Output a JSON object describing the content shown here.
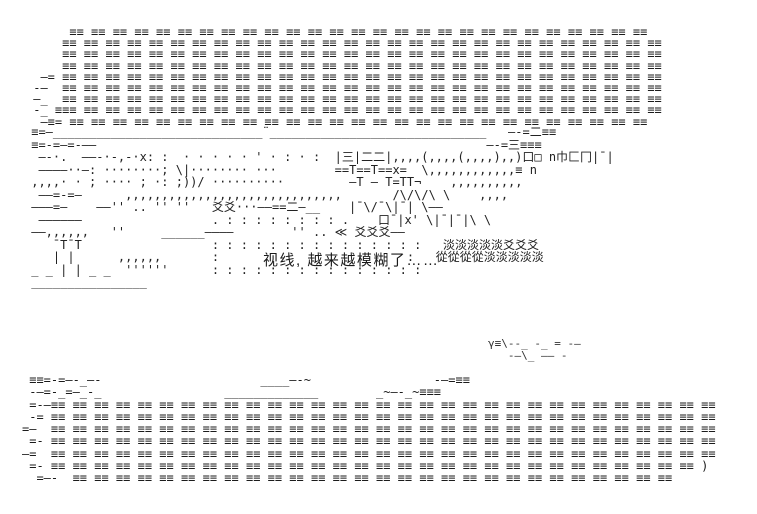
{
  "page": {
    "background_color": "#ffffff",
    "ink_color": "#1b1b1b",
    "description": "Monochrome ASCII-art (AA) scene: dense banner bands of triple-bar glyphs at top and bottom, a sketchy dotted landscape with rooftops and foliage glyphs in the middle, and one line of Chinese dialogue in a dotted speech box."
  },
  "dialog": {
    "text": "视线, 越来越模糊了……"
  },
  "aa": {
    "foliage_glyphs": "爻 淡 從",
    "top_banner": [
      "      ≡≡ ≡≡ ≡≡ ≡≡ ≡≡ ≡≡ ≡≡ ≡≡ ≡≡ ≡≡ ≡≡ ≡≡ ≡≡ ≡≡ ≡≡ ≡≡ ≡≡ ≡≡ ≡≡ ≡≡ ≡≡ ≡≡ ≡≡ ≡≡ ≡≡ ≡≡ ≡≡",
      "     ≡≡ ≡≡ ≡≡ ≡≡ ≡≡ ≡≡ ≡≡ ≡≡ ≡≡ ≡≡ ≡≡ ≡≡ ≡≡ ≡≡ ≡≡ ≡≡ ≡≡ ≡≡ ≡≡ ≡≡ ≡≡ ≡≡ ≡≡ ≡≡ ≡≡ ≡≡ ≡≡ ≡≡",
      "     ≡≡ ≡≡ ≡≡ ≡≡ ≡≡ ≡≡ ≡≡ ≡≡ ≡≡ ≡≡ ≡≡ ≡≡ ≡≡ ≡≡ ≡≡ ≡≡ ≡≡ ≡≡ ≡≡ ≡≡ ≡≡ ≡≡ ≡≡ ≡≡ ≡≡ ≡≡ ≡≡ ≡≡",
      "     ≡≡ ≡≡ ≡≡ ≡≡ ≡≡ ≡≡ ≡≡ ≡≡ ≡≡ ≡≡ ≡≡ ≡≡ ≡≡ ≡≡ ≡≡ ≡≡ ≡≡ ≡≡ ≡≡ ≡≡ ≡≡ ≡≡ ≡≡ ≡≡ ≡≡ ≡≡ ≡≡ ≡≡",
      "  —= ≡≡ ≡≡ ≡≡ ≡≡ ≡≡ ≡≡ ≡≡ ≡≡ ≡≡ ≡≡ ≡≡ ≡≡ ≡≡ ≡≡ ≡≡ ≡≡ ≡≡ ≡≡ ≡≡ ≡≡ ≡≡ ≡≡ ≡≡ ≡≡ ≡≡ ≡≡ ≡≡ ≡≡",
      " -—  ≡≡ ≡≡ ≡≡ ≡≡ ≡≡ ≡≡ ≡≡ ≡≡ ≡≡ ≡≡ ≡≡ ≡≡ ≡≡ ≡≡ ≡≡ ≡≡ ≡≡ ≡≡ ≡≡ ≡≡ ≡≡ ≡≡ ≡≡ ≡≡ ≡≡ ≡≡ ≡≡ ≡≡",
      " —_  ≡≡ ≡≡ ≡≡ ≡≡ ≡≡ ≡≡ ≡≡ ≡≡ ≡≡ ≡≡ ≡≡ ≡≡ ≡≡ ≡≡ ≡≡ ≡≡ ≡≡ ≡≡ ≡≡ ≡≡ ≡≡ ≡≡ ≡≡ ≡≡ ≡≡ ≡≡ ≡≡ ≡≡",
      " -_ ≡≡≡ ≡≡ ≡≡ ≡≡ ≡≡ ≡≡ ≡≡ ≡≡ ≡≡ ≡≡ ≡≡ ≡≡ ≡≡ ≡≡ ≡≡ ≡≡ ≡≡ ≡≡ ≡≡ ≡≡ ≡≡ ≡≡ ≡≡ ≡≡ ≡≡ ≡≡ ≡≡ ≡≡",
      "  —≡= ≡≡ ≡≡ ≡≡ ≡≡ ≡≡ ≡≡ ≡≡ ≡≡ ≡≡ ≡≡ ≡≡ ≡≡ ≡≡ ≡≡ ≡≡ ≡≡ ≡≡ ≡≡ ≡≡ ≡≡ ≡≡ ≡≡ ≡≡ ≡≡ ≡≡ ≡≡ ≡≡"
    ],
    "scene": [
      " ≡=—_____________________________¨______________________________   —-=二≡≡",
      " ≡=-=—=-——                                                      —-=三≡≡≡",
      "  —-·.  ——-·-,-·x: :  · · · · · ' · : · :  |三|二二|,,,,(,,,,(,,,,),,)口□ n巾匚冂|¯|",
      "  ————··—: ········; \\|········ ···        ==T==T==x=  \\,,,,,,,,,,,,≡ n",
      " ,,,,· · ; ···· ; ·: ;))/ ··········         —T – T=TT¬    ,,,,,,,,,,",
      "  ——=-=—      ,,,,,,,,,,,,,,,,,,,,,,,,,,,,,,       /\\/\\/\\ \\    ,,,,",
      " ———=—    ——'' .. '' ''   爻爻···——==二—__    |¯\\/¯\\|¯| \\——",
      "  ——————                  . : : : : : : : : .    口¯|x' \\|¯|¯|\\ \\",
      " ——,,,,,,   ''     ______————        '' .. ≪ 爻爻爻——",
      "    ¯T¯T                  : : : : : : : : : : : : : : :   淡淡淡淡淡爻爻爻",
      "    | |      ,,,,,,       :                          :   從從從從淡淡淡淡淡",
      " _ _ | | _ _  ''''''      : : : : : : : : : : : : : : :",
      " ________________"
    ],
    "drift": [
      "γ≡\\--_ -_ = -—",
      "   -—\\_ —— -"
    ],
    "bottom_banner": [
      " ≡≡=-=—-_—-                      ____—-~                 -—=≡≡",
      " -—=-_=—_-_                 _____________        _~—-_~≡≡≡",
      " =-—≡≡ ≡≡ ≡≡ ≡≡ ≡≡ ≡≡ ≡≡ ≡≡ ≡≡ ≡≡ ≡≡ ≡≡ ≡≡ ≡≡ ≡≡ ≡≡ ≡≡ ≡≡ ≡≡ ≡≡ ≡≡ ≡≡ ≡≡ ≡≡ ≡≡ ≡≡ ≡≡ ≡≡ ≡≡ ≡≡ ≡≡",
      " -= ≡≡ ≡≡ ≡≡ ≡≡ ≡≡ ≡≡ ≡≡ ≡≡ ≡≡ ≡≡ ≡≡ ≡≡ ≡≡ ≡≡ ≡≡ ≡≡ ≡≡ ≡≡ ≡≡ ≡≡ ≡≡ ≡≡ ≡≡ ≡≡ ≡≡ ≡≡ ≡≡ ≡≡ ≡≡ ≡≡ ≡≡",
      "=—  ≡≡ ≡≡ ≡≡ ≡≡ ≡≡ ≡≡ ≡≡ ≡≡ ≡≡ ≡≡ ≡≡ ≡≡ ≡≡ ≡≡ ≡≡ ≡≡ ≡≡ ≡≡ ≡≡ ≡≡ ≡≡ ≡≡ ≡≡ ≡≡ ≡≡ ≡≡ ≡≡ ≡≡ ≡≡ ≡≡ ≡≡",
      " =- ≡≡ ≡≡ ≡≡ ≡≡ ≡≡ ≡≡ ≡≡ ≡≡ ≡≡ ≡≡ ≡≡ ≡≡ ≡≡ ≡≡ ≡≡ ≡≡ ≡≡ ≡≡ ≡≡ ≡≡ ≡≡ ≡≡ ≡≡ ≡≡ ≡≡ ≡≡ ≡≡ ≡≡ ≡≡ ≡≡ ≡≡",
      "—=  ≡≡ ≡≡ ≡≡ ≡≡ ≡≡ ≡≡ ≡≡ ≡≡ ≡≡ ≡≡ ≡≡ ≡≡ ≡≡ ≡≡ ≡≡ ≡≡ ≡≡ ≡≡ ≡≡ ≡≡ ≡≡ ≡≡ ≡≡ ≡≡ ≡≡ ≡≡ ≡≡ ≡≡ ≡≡ ≡≡ ≡≡",
      " =- ≡≡ ≡≡ ≡≡ ≡≡ ≡≡ ≡≡ ≡≡ ≡≡ ≡≡ ≡≡ ≡≡ ≡≡ ≡≡ ≡≡ ≡≡ ≡≡ ≡≡ ≡≡ ≡≡ ≡≡ ≡≡ ≡≡ ≡≡ ≡≡ ≡≡ ≡≡ ≡≡ ≡≡ ≡≡ ≡≡ )",
      "  =—-  ≡≡ ≡≡ ≡≡ ≡≡ ≡≡ ≡≡ ≡≡ ≡≡ ≡≡ ≡≡ ≡≡ ≡≡ ≡≡ ≡≡ ≡≡ ≡≡ ≡≡ ≡≡ ≡≡ ≡≡ ≡≡ ≡≡ ≡≡ ≡≡ ≡≡ ≡≡ ≡≡ ≡≡"
    ]
  }
}
